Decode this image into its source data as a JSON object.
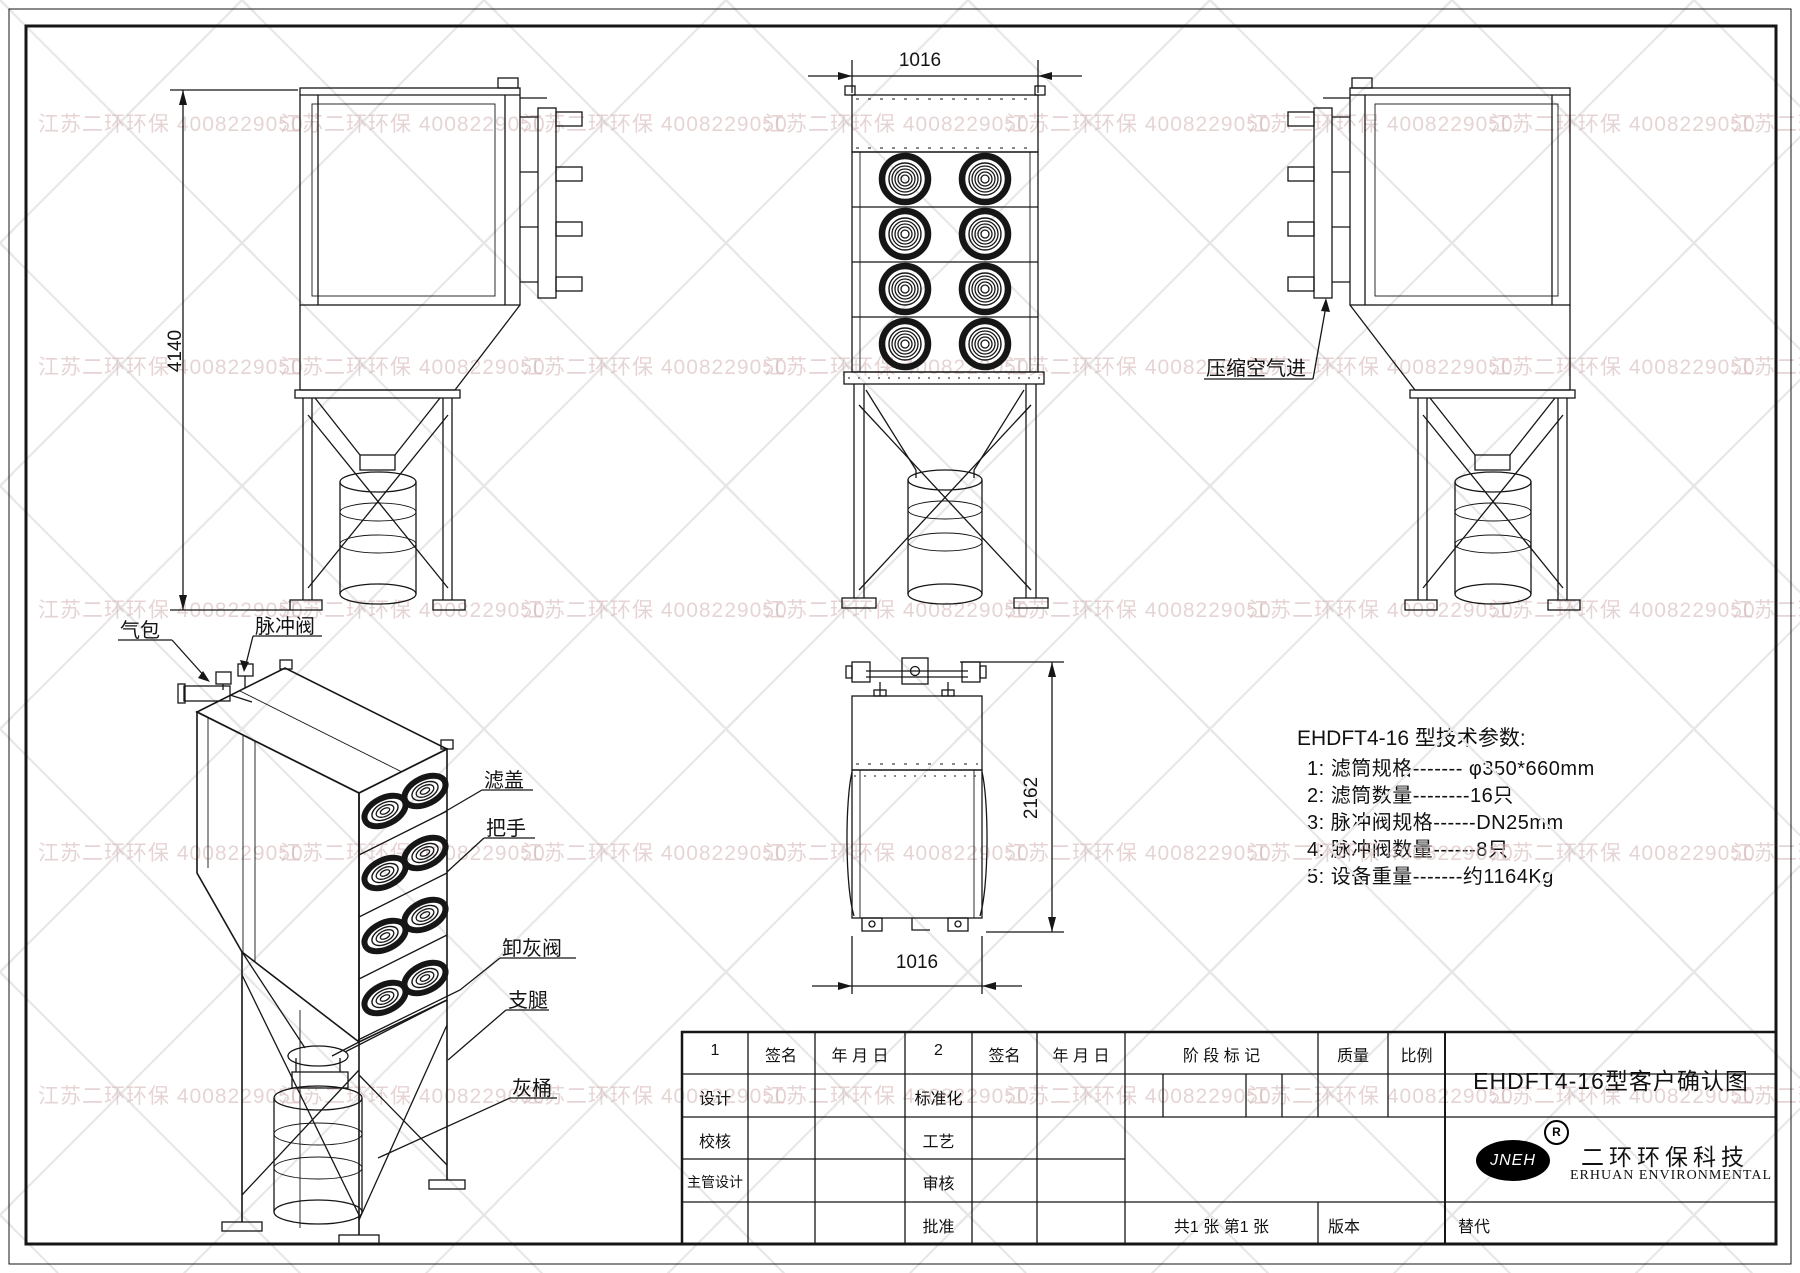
{
  "watermark": {
    "text": "江苏二环环保 4008229050",
    "color": "#d2b2b2"
  },
  "dimensions": {
    "overall_height": "4140",
    "front_width": "1016",
    "depth": "2162",
    "top_width": "1016"
  },
  "annotations": {
    "compressed_air_inlet": "压缩空气进",
    "air_bag": "气包",
    "pulse_valve": "脉冲阀",
    "filter_cover": "滤盖",
    "handle": "把手",
    "ash_valve": "卸灰阀",
    "support_leg": "支腿",
    "ash_bucket": "灰桶"
  },
  "specs": {
    "title": "EHDFT4-16 型技术参数:",
    "items": [
      "1:  滤筒规格------- φ350*660mm",
      "2:  滤筒数量--------16只",
      "3:  脉冲阀规格------DN25mm",
      "4:  脉冲阀数量------8只",
      "5:  设备重量-------约1164Kg"
    ]
  },
  "title_block": {
    "col1_header": "1",
    "sign1": "签名",
    "date1": "年 月 日",
    "col2_header": "2",
    "sign2": "签名",
    "date2": "年 月 日",
    "stage_mark": "阶 段 标 记",
    "quality": "质量",
    "scale": "比例",
    "design": "设计",
    "standardization": "标准化",
    "check": "校核",
    "process": "工艺",
    "chief_design": "主管设计",
    "review": "审核",
    "approve": "批准",
    "sheets": "共1 张  第1 张",
    "version": "版本",
    "substitute": "替代",
    "drawing_title": "EHDFT4-16型客户确认图",
    "company_cn": "二环环保科技",
    "company_en": "ERHUAN ENVIRONMENTAL",
    "logo_text": "JNEH",
    "registered": "R"
  }
}
